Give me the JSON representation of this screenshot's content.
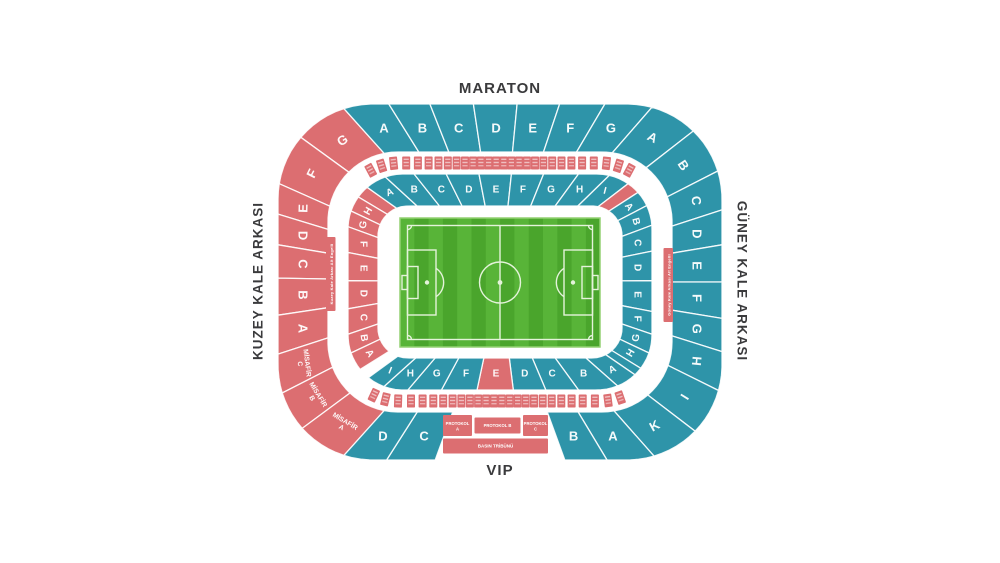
{
  "stands": {
    "top": "MARATON",
    "bottom": "VIP",
    "left": "KUZEY KALE ARKASI",
    "right": "GÜNEY KALE ARKASI"
  },
  "colors": {
    "teal": "#2E94A9",
    "red": "#DC6E71",
    "label": "#3A3A3C",
    "pitch_light": "#58B438",
    "pitch_dark": "#4AA52C",
    "pitch_line": "#E4F3DA",
    "pitch_frame": "#93D172"
  },
  "rings": [
    {
      "name": "outer",
      "sections": [
        {
          "label": "G",
          "from": 216,
          "to": 228,
          "color": "red"
        },
        {
          "label": "F",
          "from": 204,
          "to": 216,
          "color": "red"
        },
        {
          "label": "E",
          "from": 197,
          "to": 204,
          "color": "red"
        },
        {
          "label": "D",
          "from": 189.5,
          "to": 197,
          "color": "red"
        },
        {
          "label": "C",
          "from": 181,
          "to": 189.5,
          "color": "red"
        },
        {
          "label": "B",
          "from": 171.5,
          "to": 181,
          "color": "red"
        },
        {
          "label": "A",
          "from": 162,
          "to": 171.5,
          "color": "red"
        },
        {
          "label": "MİSAFİR\nC",
          "from": 153,
          "to": 162,
          "color": "red"
        },
        {
          "label": "MİSAFİR\nB",
          "from": 143.5,
          "to": 153,
          "color": "red"
        },
        {
          "label": "MİSAFİR\nA",
          "from": 132,
          "to": 143.5,
          "color": "red"
        },
        {
          "label": "A",
          "from": 228,
          "to": 238,
          "color": "teal"
        },
        {
          "label": "B",
          "from": 238,
          "to": 248.5,
          "color": "teal"
        },
        {
          "label": "C",
          "from": 248.5,
          "to": 261.5,
          "color": "teal"
        },
        {
          "label": "D",
          "from": 261.5,
          "to": 275.5,
          "color": "teal"
        },
        {
          "label": "E",
          "from": 275.5,
          "to": 288.5,
          "color": "teal"
        },
        {
          "label": "F",
          "from": 288.5,
          "to": 300.5,
          "color": "teal"
        },
        {
          "label": "G",
          "from": 300.5,
          "to": 311,
          "color": "teal"
        },
        {
          "label": "A",
          "from": 311,
          "to": 322,
          "color": "teal"
        },
        {
          "label": "B",
          "from": 322,
          "to": 333,
          "color": "teal"
        },
        {
          "label": "C",
          "from": 333,
          "to": 342,
          "color": "teal"
        },
        {
          "label": "D",
          "from": 342,
          "to": 350.5,
          "color": "teal"
        },
        {
          "label": "E",
          "from": 350.5,
          "to": 360,
          "color": "teal"
        },
        {
          "label": "F",
          "from": 0,
          "to": 9.3,
          "color": "teal"
        },
        {
          "label": "G",
          "from": 9.3,
          "to": 17.4,
          "color": "teal"
        },
        {
          "label": "H",
          "from": 17.4,
          "to": 26.4,
          "color": "teal"
        },
        {
          "label": "I",
          "from": 26.4,
          "to": 37.4,
          "color": "teal"
        },
        {
          "label": "K",
          "from": 37.4,
          "to": 48.5,
          "color": "teal"
        },
        {
          "label": "A",
          "from": 48.5,
          "to": 59,
          "color": "teal"
        },
        {
          "label": "B",
          "from": 59,
          "to": 70,
          "color": "teal"
        },
        {
          "label": "C",
          "from": 110,
          "to": 122.5,
          "color": "teal"
        },
        {
          "label": "D",
          "from": 122.5,
          "to": 132,
          "color": "teal"
        }
      ]
    },
    {
      "name": "inner",
      "sections": [
        {
          "label": "",
          "from": 211,
          "to": 215.5,
          "color": "red"
        },
        {
          "label": "H",
          "from": 205.5,
          "to": 211,
          "color": "red"
        },
        {
          "label": "G",
          "from": 200,
          "to": 205.5,
          "color": "red"
        },
        {
          "label": "F",
          "from": 191,
          "to": 200,
          "color": "red"
        },
        {
          "label": "E",
          "from": 180.5,
          "to": 191,
          "color": "red"
        },
        {
          "label": "D",
          "from": 170,
          "to": 180.5,
          "color": "red"
        },
        {
          "label": "C",
          "from": 161,
          "to": 170,
          "color": "red"
        },
        {
          "label": "B",
          "from": 154.5,
          "to": 161,
          "color": "red"
        },
        {
          "label": "A",
          "from": 148,
          "to": 154.5,
          "color": "red"
        },
        {
          "label": "A",
          "from": 215.5,
          "to": 222.5,
          "color": "teal"
        },
        {
          "label": "B",
          "from": 222.5,
          "to": 231.5,
          "color": "teal"
        },
        {
          "label": "C",
          "from": 231.5,
          "to": 243.5,
          "color": "teal"
        },
        {
          "label": "D",
          "from": 243.5,
          "to": 259,
          "color": "teal"
        },
        {
          "label": "E",
          "from": 259,
          "to": 276,
          "color": "teal"
        },
        {
          "label": "F",
          "from": 276,
          "to": 292,
          "color": "teal"
        },
        {
          "label": "G",
          "from": 292,
          "to": 306,
          "color": "teal"
        },
        {
          "label": "H",
          "from": 306,
          "to": 315.7,
          "color": "teal"
        },
        {
          "label": "I",
          "from": 315.7,
          "to": 322.5,
          "color": "teal"
        },
        {
          "label": "",
          "from": 322.5,
          "to": 327,
          "color": "red"
        },
        {
          "label": "A",
          "from": 327,
          "to": 332.5,
          "color": "teal"
        },
        {
          "label": "B",
          "from": 332.5,
          "to": 339.5,
          "color": "teal"
        },
        {
          "label": "C",
          "from": 339.5,
          "to": 348.5,
          "color": "teal"
        },
        {
          "label": "D",
          "from": 348.5,
          "to": 359.5,
          "color": "teal"
        },
        {
          "label": "E",
          "from": 359.5,
          "to": 371,
          "color": "teal"
        },
        {
          "label": "F",
          "from": 11,
          "to": 19,
          "color": "teal"
        },
        {
          "label": "G",
          "from": 19,
          "to": 25.5,
          "color": "teal"
        },
        {
          "label": "H",
          "from": 25.5,
          "to": 31.5,
          "color": "teal"
        },
        {
          "label": "",
          "from": 31.5,
          "to": 34.5,
          "color": "teal"
        },
        {
          "label": "A",
          "from": 34.5,
          "to": 41.5,
          "color": "teal"
        },
        {
          "label": "B",
          "from": 41.5,
          "to": 54,
          "color": "teal"
        },
        {
          "label": "C",
          "from": 54,
          "to": 67,
          "color": "teal"
        },
        {
          "label": "D",
          "from": 67,
          "to": 83,
          "color": "teal"
        },
        {
          "label": "E",
          "from": 83,
          "to": 102,
          "color": "red"
        },
        {
          "label": "F",
          "from": 102,
          "to": 118.5,
          "color": "teal"
        },
        {
          "label": "G",
          "from": 118.5,
          "to": 130.5,
          "color": "teal"
        },
        {
          "label": "H",
          "from": 130.5,
          "to": 138,
          "color": "teal"
        },
        {
          "label": "I",
          "from": 138,
          "to": 144,
          "color": "teal"
        }
      ]
    }
  ],
  "loge_strips": [
    {
      "side": "top",
      "from": 219,
      "to": 321,
      "count": 28
    },
    {
      "side": "bottom",
      "from": 42,
      "to": 140,
      "count": 26
    }
  ],
  "accessible_strips": [
    {
      "side": "left",
      "label": "Kuzey Kale Arkası Alt Engelli"
    },
    {
      "side": "right",
      "label": "Güney Kale Arkası Alt Engelli"
    }
  ],
  "protocol_area": {
    "boxes": [
      "PROTOKOL\nA",
      "PROTOKOL B",
      "PROTOKOL\nC"
    ],
    "press_box": "BASIN TRİBÜNÜ"
  }
}
